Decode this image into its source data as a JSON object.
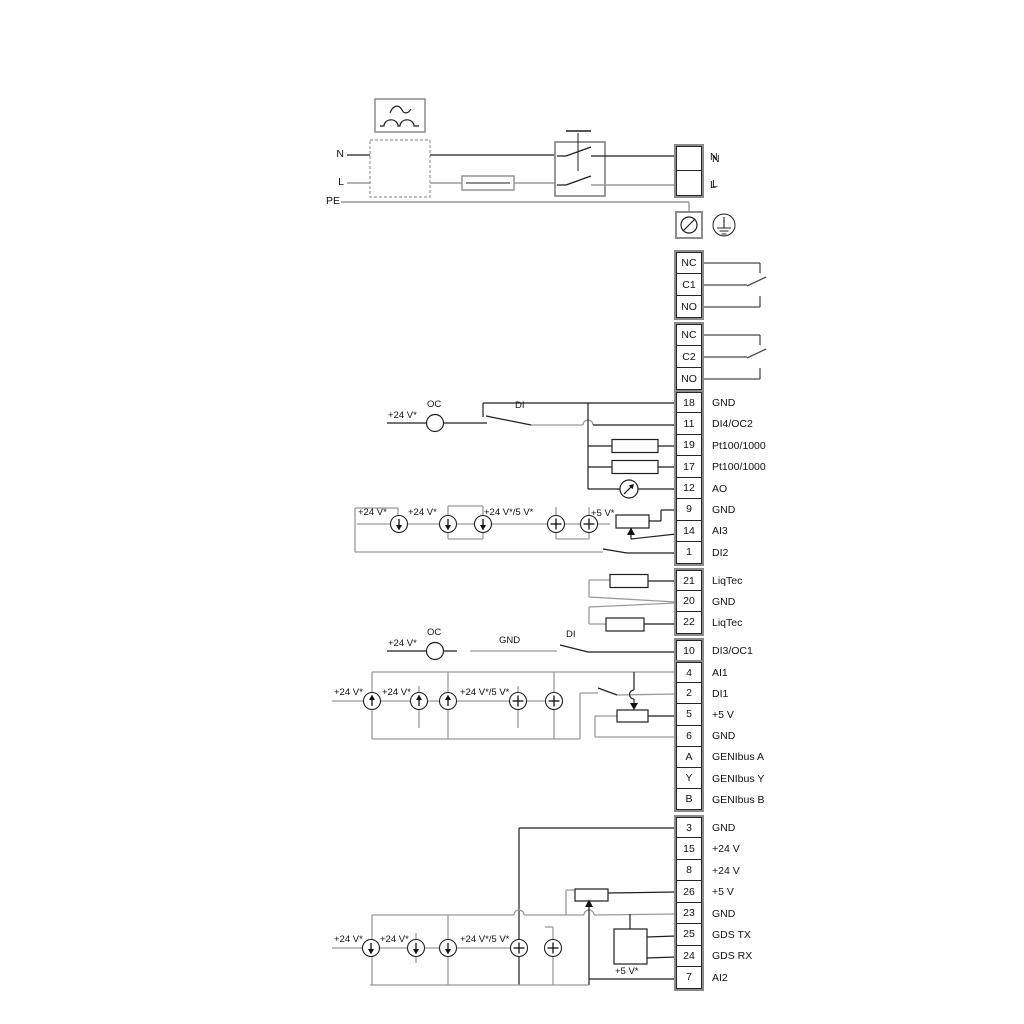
{
  "colors": {
    "wire_dark": "#1f1f1f",
    "wire_gray": "#9a9a9a",
    "terminal_border": "#8c8c8c"
  },
  "strips": {
    "power": {
      "rows": [
        {
          "num": "",
          "label": "N"
        },
        {
          "num": "",
          "label": "L"
        }
      ]
    },
    "relay1": {
      "rows": [
        {
          "num": "NC",
          "label": ""
        },
        {
          "num": "C1",
          "label": ""
        },
        {
          "num": "NO",
          "label": ""
        }
      ]
    },
    "relay2": {
      "rows": [
        {
          "num": "NC",
          "label": ""
        },
        {
          "num": "C2",
          "label": ""
        },
        {
          "num": "NO",
          "label": ""
        }
      ]
    },
    "io1": {
      "rows": [
        {
          "num": "18",
          "label": "GND"
        },
        {
          "num": "11",
          "label": "DI4/OC2"
        },
        {
          "num": "19",
          "label": "Pt100/1000"
        },
        {
          "num": "17",
          "label": "Pt100/1000"
        },
        {
          "num": "12",
          "label": "AO"
        },
        {
          "num": "9",
          "label": "GND"
        },
        {
          "num": "14",
          "label": "AI3"
        },
        {
          "num": "1",
          "label": "DI2"
        }
      ]
    },
    "liqtec": {
      "rows": [
        {
          "num": "21",
          "label": "LiqTec"
        },
        {
          "num": "20",
          "label": "GND"
        },
        {
          "num": "22",
          "label": "LiqTec"
        }
      ]
    },
    "di3": {
      "rows": [
        {
          "num": "10",
          "label": "DI3/OC1"
        }
      ]
    },
    "io2": {
      "rows": [
        {
          "num": "4",
          "label": "AI1"
        },
        {
          "num": "2",
          "label": "DI1"
        },
        {
          "num": "5",
          "label": "+5 V"
        },
        {
          "num": "6",
          "label": "GND"
        },
        {
          "num": "A",
          "label": "GENIbus A"
        },
        {
          "num": "Y",
          "label": "GENIbus Y"
        },
        {
          "num": "B",
          "label": "GENIbus B"
        }
      ]
    },
    "io3": {
      "rows": [
        {
          "num": "3",
          "label": "GND"
        },
        {
          "num": "15",
          "label": "+24 V"
        },
        {
          "num": "8",
          "label": "+24 V"
        },
        {
          "num": "26",
          "label": "+5 V"
        },
        {
          "num": "23",
          "label": "GND"
        },
        {
          "num": "25",
          "label": "GDS TX"
        },
        {
          "num": "24",
          "label": "GDS RX"
        },
        {
          "num": "7",
          "label": "AI2"
        }
      ]
    }
  },
  "wiring_labels": {
    "pl_n": "N",
    "pl_l": "L",
    "pl_pe": "PE",
    "pt_n": "N",
    "pt_l": "L",
    "oc2_v24": "+24 V*",
    "oc2_oc": "OC",
    "oc2_di": "DI",
    "s1_v24a": "+24 V*",
    "s1_v24b": "+24 V*",
    "s1_v245": "+24 V*/5 V*",
    "s1_v5": "+5 V*",
    "oc1_v24": "+24 V*",
    "oc1_oc": "OC",
    "oc1_gnd": "GND",
    "oc1_di": "DI",
    "s4_v24a": "+24 V*",
    "s4_v24b": "+24 V*",
    "s4_v245": "+24 V*/5 V*",
    "s5_v24a": "+24 V*",
    "s5_v24b": "+24 V*",
    "s5_v245": "+24 V*/5 V*",
    "s5_v5": "+5 V*"
  }
}
